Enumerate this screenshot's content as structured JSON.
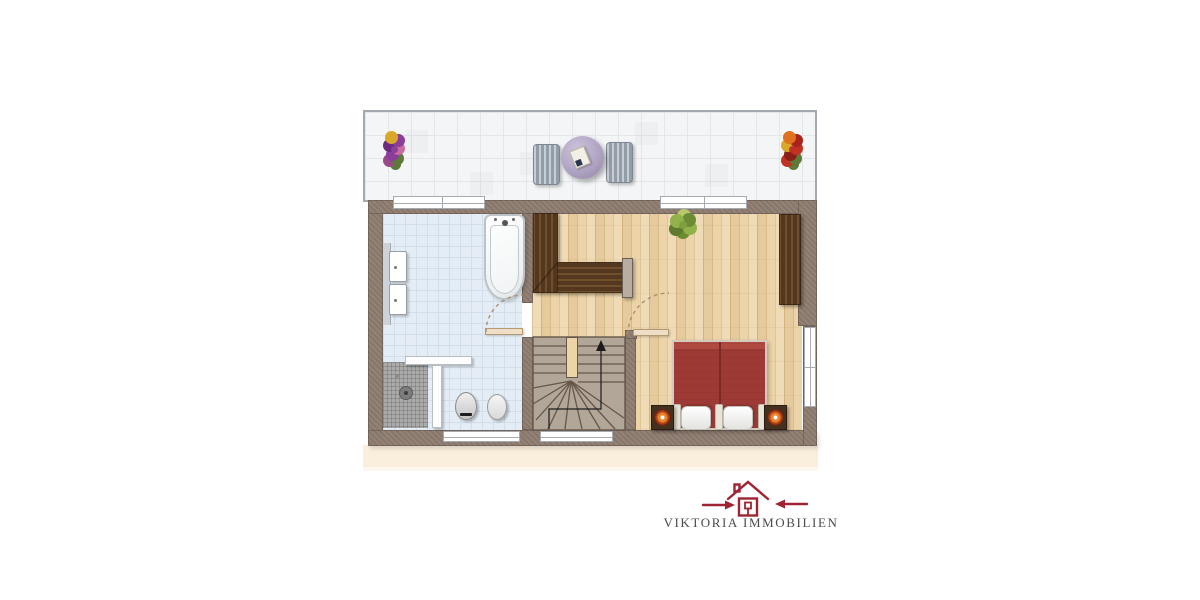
{
  "branding": {
    "logo_text": "VIKTORIA IMMOBILIEN"
  },
  "palette": {
    "background": "#ffffff",
    "wall": "#8d7b6f",
    "terrace_tile": "#f4f5f7",
    "terrace_grid": "#e4e7ea",
    "terrace_rail": "#a3a9af",
    "bathroom_tile": "#e4edf5",
    "bathroom_grid": "#d2dfea",
    "parquet": "#ecd4a8",
    "parquet_line": "#d8b988",
    "stairs_fill": "#b2a698",
    "stairs_line": "#655749",
    "wardrobe_dark": "#53381f",
    "wardrobe_stripe": "#6f4f2c",
    "bed_red": "#9e3a35",
    "beige_shadow": "#faeedd",
    "shower_tile": "#ababab",
    "bench_gray": "#9aa3ad",
    "table_lavender": "#b0a4c4",
    "window_frame": "#a5abb0",
    "door_arc": "#a98f6e",
    "logo_red": "#9f2433",
    "logo_text_color": "#4b4b4b"
  },
  "floor_plan": {
    "floor_label": "",
    "rooms": [
      {
        "id": "terrace",
        "furniture": [
          "flower-pot-left",
          "lounger-left",
          "round-table",
          "lounger-right",
          "flower-pot-right"
        ]
      },
      {
        "id": "bathroom",
        "furniture": [
          "vanity-basins",
          "bathtub",
          "shower",
          "toilet",
          "bidet",
          "partition-wall",
          "door-swing"
        ]
      },
      {
        "id": "hall",
        "furniture": [
          "built-in-wardrobe-l",
          "staircase-up-arrow",
          "door-swing"
        ]
      },
      {
        "id": "bedroom",
        "furniture": [
          "double-bed",
          "nightstand-left",
          "nightstand-right",
          "wardrobe-right",
          "plant"
        ]
      }
    ]
  }
}
